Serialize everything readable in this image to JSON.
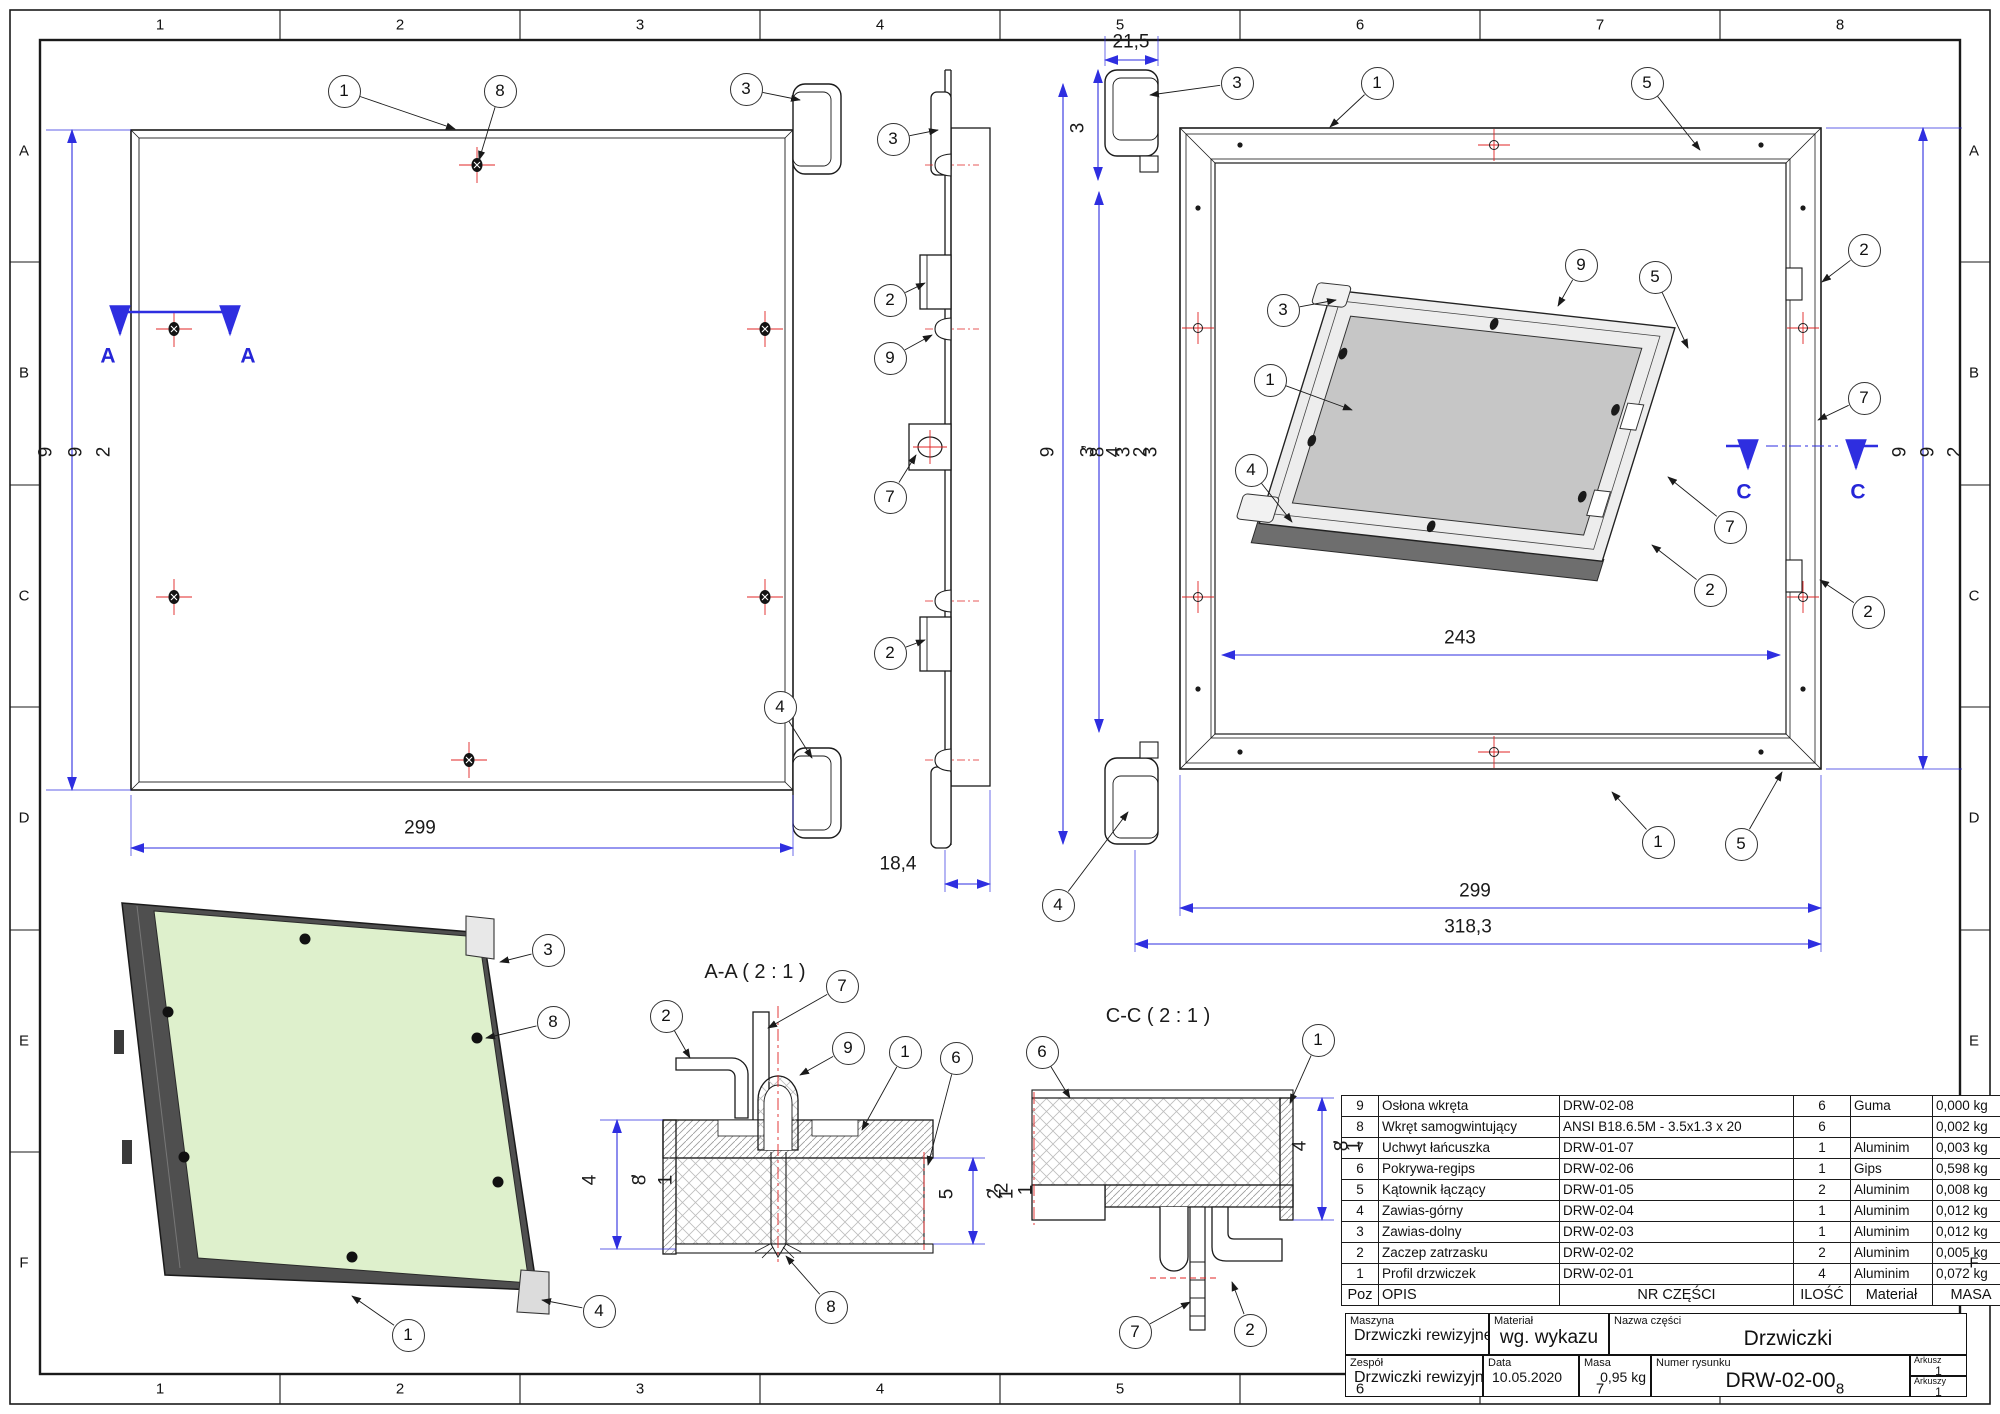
{
  "sheet": {
    "kind": "technical-drawing"
  },
  "colors": {
    "dim_blue": "#2e2ee0",
    "center_red": "#e02424",
    "panel_green": "#def0cc",
    "frame_gray": "#4f4f4f",
    "door_gray": "#c6c6c6",
    "line": "#1a1a1a"
  },
  "grid": {
    "cols": [
      "1",
      "2",
      "3",
      "4",
      "5",
      "6",
      "7",
      "8"
    ],
    "rows": [
      "A",
      "B",
      "C",
      "D",
      "E",
      "F"
    ]
  },
  "sections": {
    "aa_title": "A-A ( 2 : 1 )",
    "cc_title": "C-C ( 2 : 1 )"
  },
  "bom": {
    "headers": {
      "poz": "Poz",
      "opis": "OPIS",
      "nr": "NR CZĘŚCI",
      "ilosc": "ILOŚĆ",
      "material": "Materiał",
      "masa": "MASA"
    },
    "rows": [
      {
        "poz": "9",
        "opis": "Osłona wkręta",
        "nr": "DRW-02-08",
        "ilosc": "6",
        "material": "Guma",
        "masa": "0,000 kg"
      },
      {
        "poz": "8",
        "opis": "Wkręt samogwintujący",
        "nr": "ANSI B18.6.5M - 3.5x1.3 x 20",
        "ilosc": "6",
        "material": "",
        "masa": "0,002 kg"
      },
      {
        "poz": "7",
        "opis": "Uchwyt łańcuszka",
        "nr": "DRW-01-07",
        "ilosc": "1",
        "material": "Aluminim",
        "masa": "0,003 kg"
      },
      {
        "poz": "6",
        "opis": "Pokrywa-regips",
        "nr": "DRW-02-06",
        "ilosc": "1",
        "material": "Gips",
        "masa": "0,598 kg"
      },
      {
        "poz": "5",
        "opis": "Kątownik łączący",
        "nr": "DRW-01-05",
        "ilosc": "2",
        "material": "Aluminim",
        "masa": "0,008 kg"
      },
      {
        "poz": "4",
        "opis": "Zawias-górny",
        "nr": "DRW-02-04",
        "ilosc": "1",
        "material": "Aluminim",
        "masa": "0,012 kg"
      },
      {
        "poz": "3",
        "opis": "Zawias-dolny",
        "nr": "DRW-02-03",
        "ilosc": "1",
        "material": "Aluminim",
        "masa": "0,012 kg"
      },
      {
        "poz": "2",
        "opis": "Zaczep zatrzasku",
        "nr": "DRW-02-02",
        "ilosc": "2",
        "material": "Aluminim",
        "masa": "0,005 kg"
      },
      {
        "poz": "1",
        "opis": "Profil drzwiczek",
        "nr": "DRW-02-01",
        "ilosc": "4",
        "material": "Aluminim",
        "masa": "0,072 kg"
      }
    ]
  },
  "title_block": {
    "maszyna_label": "Maszyna",
    "maszyna": "Drzwiczki rewizyjne",
    "material_label": "Materiał",
    "material": "wg. wykazu",
    "nazwa_label": "Nazwa części",
    "nazwa": "Drzwiczki",
    "zespol_label": "Zespół",
    "zespol": "Drzwiczki rewizyjne",
    "data_label": "Data",
    "data": "10.05.2020",
    "masa_label": "Masa",
    "masa": "0,95 kg",
    "numer_label": "Numer rysunku",
    "numer": "DRW-02-00",
    "arkusz_label": "Arkusz",
    "arkusz": "1",
    "arkuszy_label": "Arkuszy",
    "arkuszy": "1"
  },
  "annotations": {
    "balloons": [
      {
        "n": "1",
        "x": 344,
        "y": 91,
        "tx": 455,
        "ty": 129
      },
      {
        "n": "8",
        "x": 500,
        "y": 91,
        "tx": 479,
        "ty": 160
      },
      {
        "n": "3",
        "x": 746,
        "y": 89,
        "tx": 800,
        "ty": 100
      },
      {
        "n": "4",
        "x": 780,
        "y": 707,
        "tx": 812,
        "ty": 758
      },
      {
        "n": "3",
        "x": 893,
        "y": 139,
        "tx": 938,
        "ty": 130
      },
      {
        "n": "2",
        "x": 890,
        "y": 300,
        "tx": 925,
        "ty": 283
      },
      {
        "n": "9",
        "x": 890,
        "y": 358,
        "tx": 932,
        "ty": 335
      },
      {
        "n": "7",
        "x": 890,
        "y": 497,
        "tx": 916,
        "ty": 455
      },
      {
        "n": "2",
        "x": 890,
        "y": 653,
        "tx": 925,
        "ty": 640
      },
      {
        "n": "3",
        "x": 1237,
        "y": 83,
        "tx": 1150,
        "ty": 95
      },
      {
        "n": "1",
        "x": 1377,
        "y": 83,
        "tx": 1330,
        "ty": 127
      },
      {
        "n": "5",
        "x": 1647,
        "y": 83,
        "tx": 1700,
        "ty": 150
      },
      {
        "n": "2",
        "x": 1864,
        "y": 250,
        "tx": 1822,
        "ty": 282
      },
      {
        "n": "9",
        "x": 1581,
        "y": 265,
        "tx": 1558,
        "ty": 306
      },
      {
        "n": "5",
        "x": 1655,
        "y": 277,
        "tx": 1688,
        "ty": 348
      },
      {
        "n": "3",
        "x": 1283,
        "y": 310,
        "tx": 1336,
        "ty": 300
      },
      {
        "n": "1",
        "x": 1270,
        "y": 380,
        "tx": 1352,
        "ty": 410
      },
      {
        "n": "7",
        "x": 1864,
        "y": 398,
        "tx": 1818,
        "ty": 420
      },
      {
        "n": "4",
        "x": 1251,
        "y": 470,
        "tx": 1292,
        "ty": 522
      },
      {
        "n": "7",
        "x": 1730,
        "y": 527,
        "tx": 1668,
        "ty": 477
      },
      {
        "n": "2",
        "x": 1710,
        "y": 590,
        "tx": 1652,
        "ty": 545
      },
      {
        "n": "2",
        "x": 1868,
        "y": 612,
        "tx": 1820,
        "ty": 580
      },
      {
        "n": "1",
        "x": 1658,
        "y": 842,
        "tx": 1612,
        "ty": 792
      },
      {
        "n": "5",
        "x": 1741,
        "y": 844,
        "tx": 1782,
        "ty": 772
      },
      {
        "n": "4",
        "x": 1058,
        "y": 905,
        "tx": 1128,
        "ty": 812
      },
      {
        "n": "2",
        "x": 666,
        "y": 1016,
        "tx": 690,
        "ty": 1058
      },
      {
        "n": "7",
        "x": 842,
        "y": 986,
        "tx": 768,
        "ty": 1028
      },
      {
        "n": "9",
        "x": 848,
        "y": 1048,
        "tx": 800,
        "ty": 1075
      },
      {
        "n": "1",
        "x": 905,
        "y": 1052,
        "tx": 862,
        "ty": 1130
      },
      {
        "n": "6",
        "x": 956,
        "y": 1058,
        "tx": 928,
        "ty": 1165
      },
      {
        "n": "8",
        "x": 831,
        "y": 1307,
        "tx": 786,
        "ty": 1256
      },
      {
        "n": "6",
        "x": 1042,
        "y": 1052,
        "tx": 1070,
        "ty": 1098
      },
      {
        "n": "1",
        "x": 1318,
        "y": 1040,
        "tx": 1290,
        "ty": 1103
      },
      {
        "n": "7",
        "x": 1135,
        "y": 1332,
        "tx": 1190,
        "ty": 1302
      },
      {
        "n": "2",
        "x": 1250,
        "y": 1330,
        "tx": 1232,
        "ty": 1282
      },
      {
        "n": "3",
        "x": 548,
        "y": 950,
        "tx": 500,
        "ty": 962
      },
      {
        "n": "8",
        "x": 553,
        "y": 1022,
        "tx": 486,
        "ty": 1038
      },
      {
        "n": "1",
        "x": 408,
        "y": 1335,
        "tx": 352,
        "ty": 1296
      },
      {
        "n": "4",
        "x": 599,
        "y": 1311,
        "tx": 542,
        "ty": 1300
      }
    ],
    "labels": [
      {
        "t": "A-A ( 2 : 1 )",
        "x": 755,
        "y": 972,
        "cls": "ttl"
      },
      {
        "t": "C-C ( 2 : 1 )",
        "x": 1158,
        "y": 1016,
        "cls": "ttl"
      },
      {
        "t": "299",
        "x": 420,
        "y": 828
      },
      {
        "t": "18,4",
        "x": 898,
        "y": 864
      },
      {
        "t": "21,5",
        "x": 1131,
        "y": 42
      },
      {
        "t": "243",
        "x": 1460,
        "y": 638
      },
      {
        "t": "299",
        "x": 1475,
        "y": 891
      },
      {
        "t": "318,3",
        "x": 1468,
        "y": 927
      },
      {
        "t": "A",
        "x": 108,
        "y": 356,
        "cls": "blue"
      },
      {
        "t": "A",
        "x": 248,
        "y": 356,
        "cls": "blue"
      },
      {
        "t": "C",
        "x": 1744,
        "y": 492,
        "cls": "blue"
      },
      {
        "t": "C",
        "x": 1858,
        "y": 492,
        "cls": "blue"
      },
      {
        "t": "9",
        "x": 46,
        "y": 452,
        "rot": 1
      },
      {
        "t": "9",
        "x": 76,
        "y": 452,
        "rot": 1
      },
      {
        "t": "2",
        "x": 104,
        "y": 452,
        "rot": 1
      },
      {
        "t": "9",
        "x": 1900,
        "y": 452,
        "rot": 1
      },
      {
        "t": "9",
        "x": 1928,
        "y": 452,
        "rot": 1
      },
      {
        "t": "2",
        "x": 1955,
        "y": 452,
        "rot": 1
      },
      {
        "t": "3",
        "x": 1078,
        "y": 128,
        "rot": 1
      },
      {
        "t": "9",
        "x": 1048,
        "y": 452,
        "rot": 1
      },
      {
        "t": ",",
        "x": 1078,
        "y": 447,
        "rot": 1
      },
      {
        "t": "3",
        "x": 1088,
        "y": 452,
        "rot": 1
      },
      {
        "t": "8",
        "x": 1098,
        "y": 452,
        "rot": 1
      },
      {
        "t": "4",
        "x": 1114,
        "y": 452,
        "rot": 1
      },
      {
        "t": "3",
        "x": 1124,
        "y": 452,
        "rot": 1
      },
      {
        "t": "2",
        "x": 1141,
        "y": 452,
        "rot": 1
      },
      {
        "t": "3",
        "x": 1151,
        "y": 452,
        "rot": 1
      },
      {
        "t": "4",
        "x": 590,
        "y": 1180,
        "rot": 1
      },
      {
        "t": ",",
        "x": 628,
        "y": 1176,
        "rot": 1
      },
      {
        "t": "8",
        "x": 640,
        "y": 1180,
        "rot": 1
      },
      {
        "t": "1",
        "x": 666,
        "y": 1180,
        "rot": 1
      },
      {
        "t": "5",
        "x": 947,
        "y": 1194,
        "rot": 1
      },
      {
        "t": ",",
        "x": 983,
        "y": 1190,
        "rot": 1
      },
      {
        "t": "2",
        "x": 995,
        "y": 1194,
        "rot": 1
      },
      {
        "t": "1",
        "x": 1007,
        "y": 1194,
        "rot": 1
      },
      {
        "t": "4",
        "x": 1300,
        "y": 1146,
        "rot": 1
      },
      {
        "t": ",",
        "x": 1330,
        "y": 1142,
        "rot": 1
      },
      {
        "t": "8",
        "x": 1342,
        "y": 1146,
        "rot": 1
      },
      {
        "t": "1",
        "x": 1354,
        "y": 1146,
        "rot": 1
      },
      {
        "t": "2",
        "x": 1002,
        "y": 1188,
        "rot": 1
      },
      {
        "t": "1",
        "x": 1026,
        "y": 1190,
        "rot": 1
      }
    ]
  }
}
